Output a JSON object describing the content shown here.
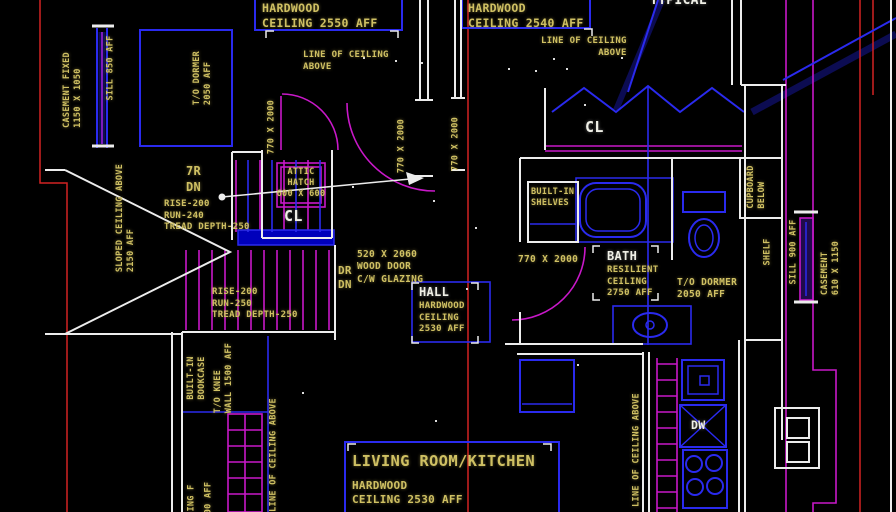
{
  "drawing_type": "architectural floor plan (CAD screenshot)",
  "colors": {
    "background": "#000000",
    "walls_white": "#ececec",
    "lines_blue": "#2a2aee",
    "lines_magenta": "#c818c8",
    "lines_red": "#d22222",
    "text_yellow": "#cfc063",
    "text_white": "#efefe6"
  },
  "labels": {
    "hardwood2550": {
      "text": "HARDWOOD\nCEILING 2550 AFF"
    },
    "lineCeilLeft": {
      "text": "LINE OF CEILING\nABOVE"
    },
    "hardwood2540": {
      "text": "HARDWOOD\nCEILING 2540 AFF"
    },
    "lineCeilRight": {
      "text": "LINE OF CEILING\nABOVE"
    },
    "typical": {
      "text": "TYPICAL"
    },
    "casementFixed": {
      "text": "CASEMENT FIXED\n1150 X 1050"
    },
    "sill850": {
      "text": "SILL 850 AFF"
    },
    "toDormerL": {
      "text": "T/O DORMER\n2050 AFF"
    },
    "slopedCeiling": {
      "text": "SLOPED CEILING ABOVE\n2150 AFF"
    },
    "sevenR": {
      "text": "7R\nDN"
    },
    "riseRun1": {
      "text": "RISE-200\nRUN-240\nTREAD DEPTH-250"
    },
    "atticHatch": {
      "text": "ATTIC\nHATCH\n600 X 600"
    },
    "clLeft": {
      "text": "CL"
    },
    "d770a": {
      "text": "770 X 2000"
    },
    "d770b": {
      "text": "770 X 2000"
    },
    "d770c": {
      "text": "770 X 2000"
    },
    "woodDoor": {
      "text": "520 X 2060\nWOOD DOOR\nC/W GLAZING"
    },
    "drDn": {
      "text": "DR\nDN"
    },
    "hall": {
      "text": "HALL"
    },
    "hallSub": {
      "text": "HARDWOOD\nCEILING\n2530 AFF"
    },
    "riseRun2": {
      "text": "RISE-200\nRUN-250\nTREAD DEPTH-250"
    },
    "builtinShelves": {
      "text": "BUILT-IN\nSHELVES"
    },
    "clRight": {
      "text": "CL"
    },
    "d770d": {
      "text": "770 X 2000"
    },
    "bath": {
      "text": "BATH"
    },
    "bathSub": {
      "text": "RESILIENT\nCEILING\n2750 AFF"
    },
    "toDormerR": {
      "text": "T/O DORMER\n2050 AFF"
    },
    "cupboardBelow": {
      "text": "CUPBOARD\nBELOW"
    },
    "shelf": {
      "text": "SHELF"
    },
    "sill900": {
      "text": "SILL 900 AFF"
    },
    "casement610": {
      "text": "CASEMENT\n610 X 1150"
    },
    "builtinBookcase": {
      "text": "BUILT-IN\nBOOKCASE"
    },
    "toKnee": {
      "text": "T/O KNEE\nWALL 1500 AFF"
    },
    "lineCeilBL": {
      "text": "LINE OF CEILING ABOVE"
    },
    "part1": {
      "text": "ING F"
    },
    "part2": {
      "text": "00 AFF"
    },
    "living": {
      "text": "LIVING ROOM/KITCHEN"
    },
    "livingSub": {
      "text": "HARDWOOD\nCEILING 2530 AFF"
    },
    "dw": {
      "text": "DW"
    },
    "lineCeilK": {
      "text": "LINE OF CEILING ABOVE"
    }
  }
}
